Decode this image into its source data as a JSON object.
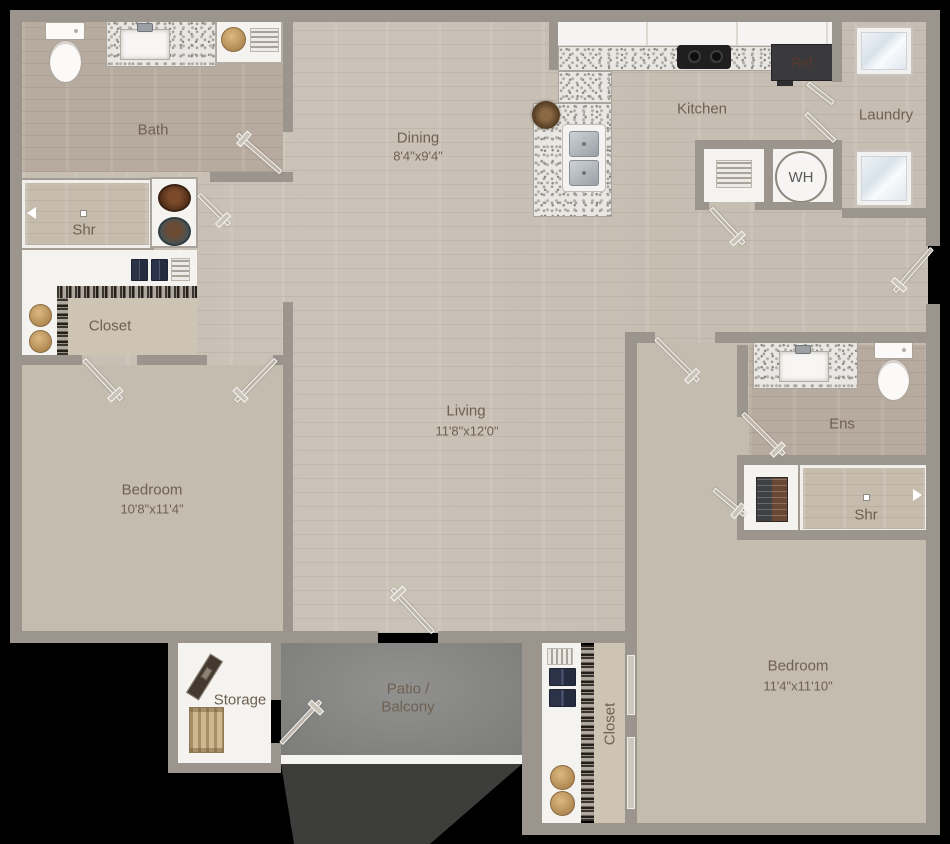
{
  "colors": {
    "background": "#000000",
    "wall": "#9c958e",
    "wood_floor": "#cbc3b8",
    "wood_floor_dark": "#b7ab9f",
    "carpet": "#c4bcae",
    "patio": "#8a8a88",
    "white_fixture": "#f4f3f0",
    "granite": "#e9e7e3",
    "label_text": "#6f6052",
    "door": "#bdb5aa"
  },
  "rooms": {
    "bath": {
      "label": "Bath"
    },
    "shr_left": {
      "label": "Shr"
    },
    "closet_left": {
      "label": "Closet"
    },
    "dining": {
      "label": "Dining",
      "dims": "8'4\"x9'4\""
    },
    "kitchen": {
      "label": "Kitchen"
    },
    "laundry": {
      "label": "Laundry"
    },
    "bedroom_left": {
      "label": "Bedroom",
      "dims": "10'8\"x11'4\""
    },
    "living": {
      "label": "Living",
      "dims": "11'8\"x12'0\""
    },
    "ens": {
      "label": "Ens"
    },
    "shr_right": {
      "label": "Shr"
    },
    "bedroom_right": {
      "label": "Bedroom",
      "dims": "11'4\"x11'10\""
    },
    "closet_right": {
      "label": "Closet"
    },
    "storage": {
      "label": "Storage"
    },
    "patio": {
      "line1": "Patio /",
      "line2": "Balcony"
    }
  },
  "appliances": {
    "water_heater_label": "WH",
    "refrigerator_label": "Ref"
  }
}
